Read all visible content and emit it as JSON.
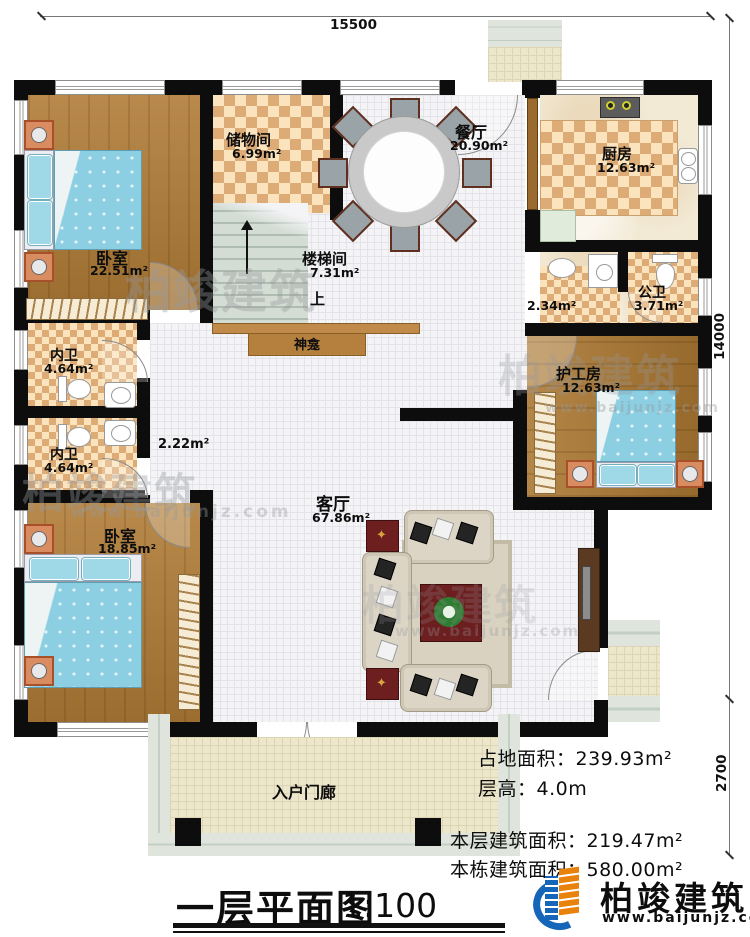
{
  "meta": {
    "title": "一层平面图",
    "scale": "1:100"
  },
  "dimensions": {
    "top": "15500",
    "right_main": "14000",
    "right_porch": "2700"
  },
  "rooms": {
    "bedroom1": {
      "name": "卧室",
      "area": "22.51m²"
    },
    "storage": {
      "name": "储物间",
      "area": "6.99m²"
    },
    "stairwell": {
      "name": "楼梯间",
      "area": "7.31m²",
      "up": "上"
    },
    "dining": {
      "name": "餐厅",
      "area": "20.90m²"
    },
    "kitchen": {
      "name": "厨房",
      "area": "12.63m²"
    },
    "vestibule": {
      "area": "2.34m²"
    },
    "public_bath": {
      "name": "公卫",
      "area": "3.71m²"
    },
    "bath1": {
      "name": "内卫",
      "area": "4.64m²"
    },
    "bath2": {
      "name": "内卫",
      "area": "4.64m²"
    },
    "corridor": {
      "area": "2.22m²"
    },
    "bedroom2": {
      "name": "卧室",
      "area": "18.85m²"
    },
    "caregiver": {
      "name": "护工房",
      "area": "12.63m²"
    },
    "living": {
      "name": "客厅",
      "area": "67.86m²"
    },
    "shrine": {
      "name": "神龛"
    },
    "entry_porch": {
      "name": "入户门廊"
    }
  },
  "info": {
    "land_area": "占地面积：239.93m²",
    "floor_height": "层高：4.0m",
    "floor_area": "本层建筑面积：219.47m²",
    "total_area": "本栋建筑面积：580.00m²"
  },
  "logo": {
    "company": "柏竣建筑",
    "website": "www.baijunjz.com"
  },
  "watermark": {
    "text": "柏竣建筑",
    "url": "www.baijunjz.com"
  }
}
